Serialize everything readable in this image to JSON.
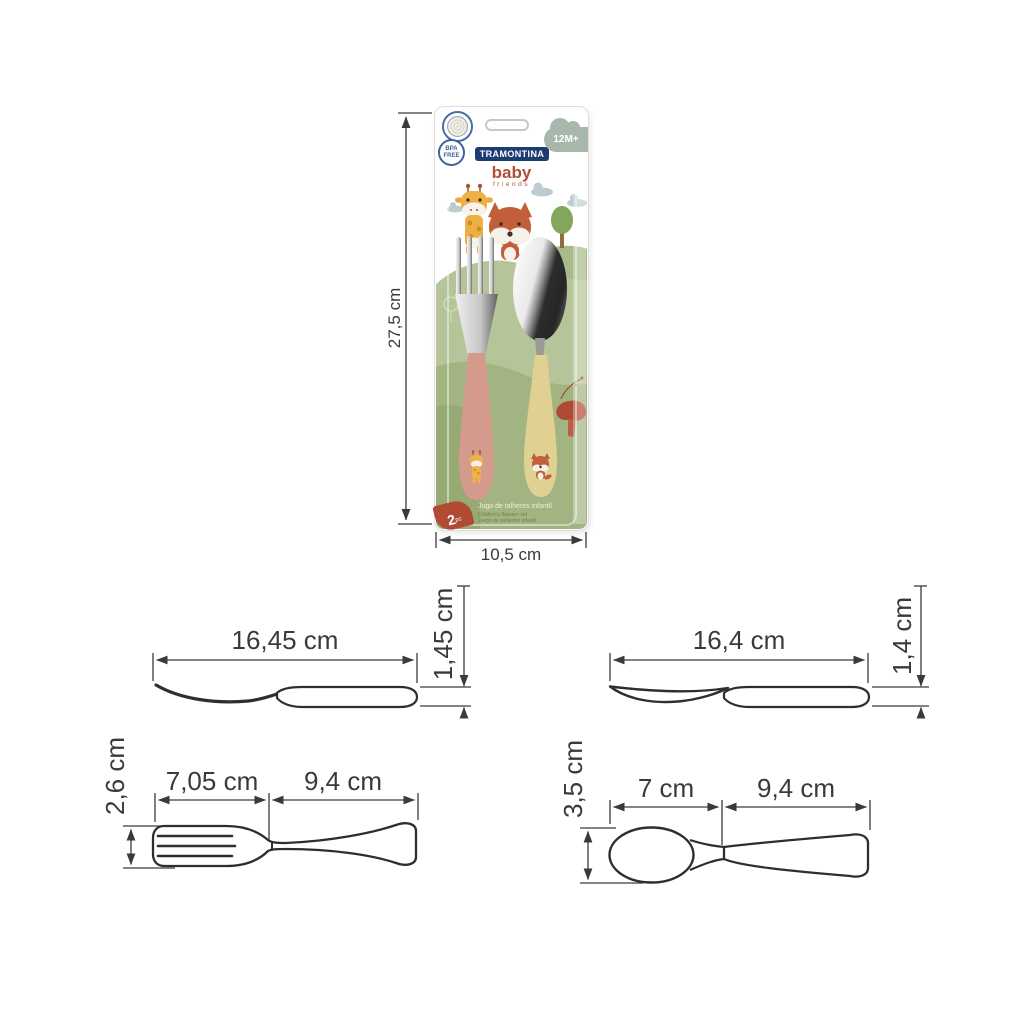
{
  "package": {
    "brand": "TRAMONTINA",
    "logo_line1": "baby",
    "logo_line2": "friends",
    "age_badge": "12M+",
    "bpa_line1": "BPA",
    "bpa_line2": "FREE",
    "pieces_count": "2",
    "pieces_unit": "pc",
    "title_pt": "Jogo de talheres infantil",
    "title_en": "Children's flatware set",
    "title_es": "Juego de cubiertos infantil",
    "height_label": "27,5 cm",
    "width_label": "10,5 cm"
  },
  "drawings": {
    "fork_side": {
      "length": "16,45 cm",
      "thickness": "1,45 cm"
    },
    "spoon_side": {
      "length": "16,4 cm",
      "thickness": "1,4 cm"
    },
    "fork_top": {
      "head_length": "7,05 cm",
      "handle_length": "9,4 cm",
      "width": "2,6 cm"
    },
    "spoon_top": {
      "bowl_length": "7 cm",
      "handle_length": "9,4 cm",
      "width": "3,5 cm"
    }
  },
  "colors": {
    "card_green": "#aabc8d",
    "hill_light": "#b5c499",
    "fork_handle_pink": "#d49a8b",
    "spoon_handle_yellow": "#e0d193",
    "brand_navy": "#1d3d72",
    "logo_red": "#b14f38",
    "badge_blue": "#3d62a0",
    "age_cloud_sage": "#a7b7ab",
    "dimension_line": "#3a3a3a"
  }
}
